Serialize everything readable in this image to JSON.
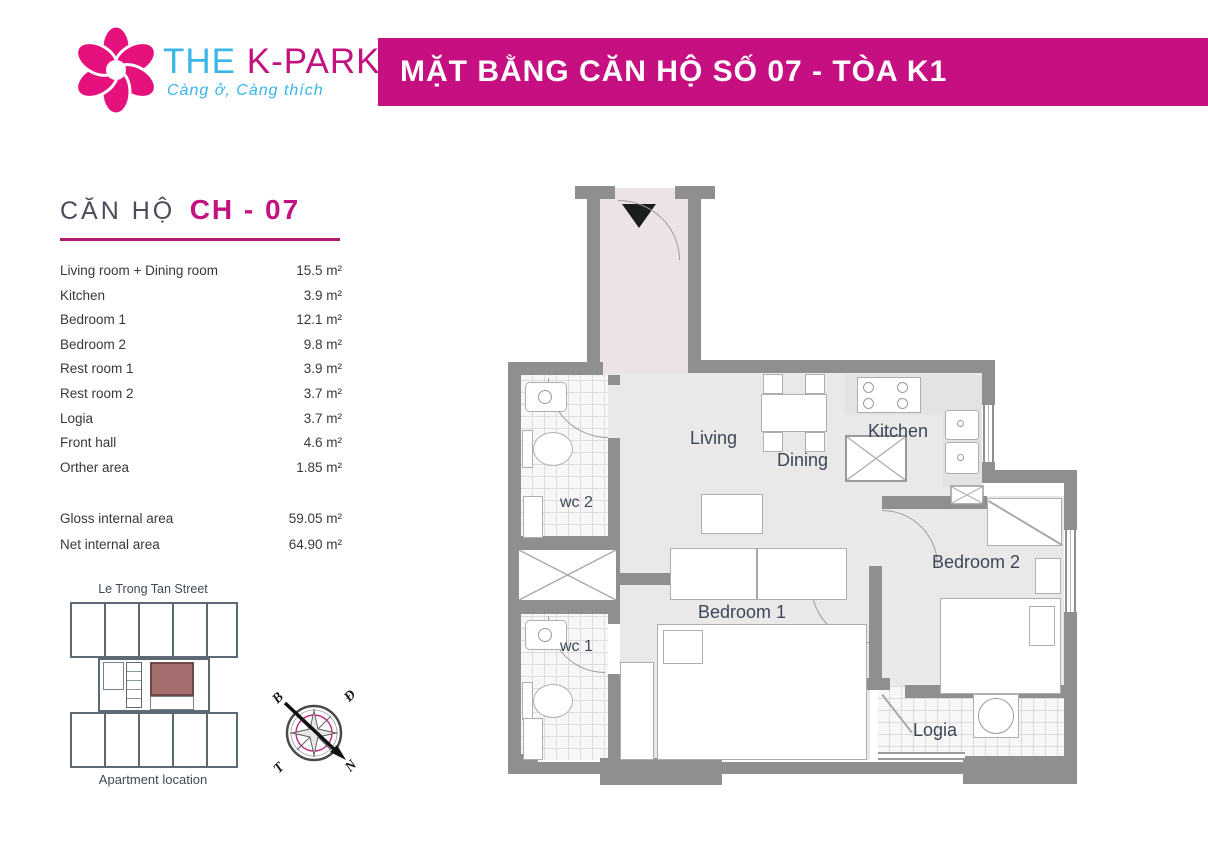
{
  "header": {
    "logo": {
      "brand_the": "THE",
      "brand_kpark": "K-PARK",
      "tagline": "Càng ở, Càng thích",
      "flower_color": "#e5127d",
      "cyan": "#38b6e8",
      "magenta": "#c3127e"
    },
    "banner": {
      "title": "MẶT BẰNG CĂN HỘ SỐ 07 - TÒA K1",
      "bg_color": "#c60f80",
      "text_color": "#ffffff"
    }
  },
  "unit_info": {
    "heading_prefix": "CĂN HỘ",
    "heading_code": "CH - 07",
    "rows": [
      {
        "label": "Living room + Dining room",
        "value": "15.5 m²"
      },
      {
        "label": "Kitchen",
        "value": "3.9 m²"
      },
      {
        "label": "Bedroom 1",
        "value": "12.1 m²"
      },
      {
        "label": "Bedroom 2",
        "value": "9.8 m²"
      },
      {
        "label": "Rest room 1",
        "value": "3.9 m²"
      },
      {
        "label": "Rest room 2",
        "value": "3.7 m²"
      },
      {
        "label": "Logia",
        "value": "3.7 m²"
      },
      {
        "label": "Front hall",
        "value": "4.6 m²"
      },
      {
        "label": "Orther area",
        "value": "1.85 m²"
      }
    ],
    "summary_rows": [
      {
        "label": "Gloss internal area",
        "value": "59.05 m²"
      },
      {
        "label": "Net internal area",
        "value": "64.90 m²"
      }
    ]
  },
  "location_map": {
    "street_label": "Le Trong Tan Street",
    "caption": "Apartment location",
    "highlight_color": "#a56f6f"
  },
  "compass": {
    "north": "B",
    "east": "Đ",
    "west": "T",
    "south": "N"
  },
  "plan": {
    "rooms": {
      "living": "Living",
      "dining": "Dining",
      "kitchen": "Kitchen",
      "bedroom1": "Bedroom 1",
      "bedroom2": "Bedroom 2",
      "wc1": "wc 1",
      "wc2": "wc 2",
      "logia": "Logia"
    },
    "colors": {
      "wall": "#8f8f8f",
      "floor": "#e9e9e9",
      "front_hall": "#ece3e8"
    }
  }
}
